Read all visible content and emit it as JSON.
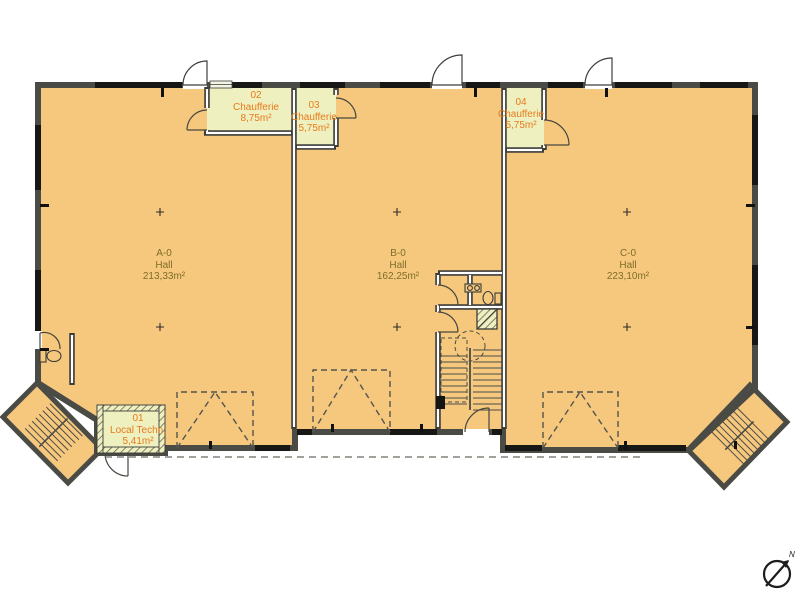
{
  "plan": {
    "halls": [
      {
        "code": "A-0",
        "label": "Hall",
        "area": "213,33m²"
      },
      {
        "code": "B-0",
        "label": "Hall",
        "area": "162,25m²"
      },
      {
        "code": "C-0",
        "label": "Hall",
        "area": "223,10m²"
      }
    ],
    "technical_rooms": [
      {
        "number": "01",
        "name": "Local Techn.",
        "area": "5,41m²"
      },
      {
        "number": "02",
        "name": "Chaufferie",
        "area": "8,75m²"
      },
      {
        "number": "03",
        "name": "Chaufferie",
        "area": "5,75m²"
      },
      {
        "number": "04",
        "name": "Chaufferie",
        "area": "5,75m²"
      }
    ],
    "compass": {
      "north_label": "N"
    },
    "colors": {
      "floor": "#F6C87E",
      "technical_room_floor": "#EFF0C0",
      "wall": "#4B4B45",
      "hall_text": "#7E6D28",
      "technical_text": "#E87A19"
    }
  }
}
